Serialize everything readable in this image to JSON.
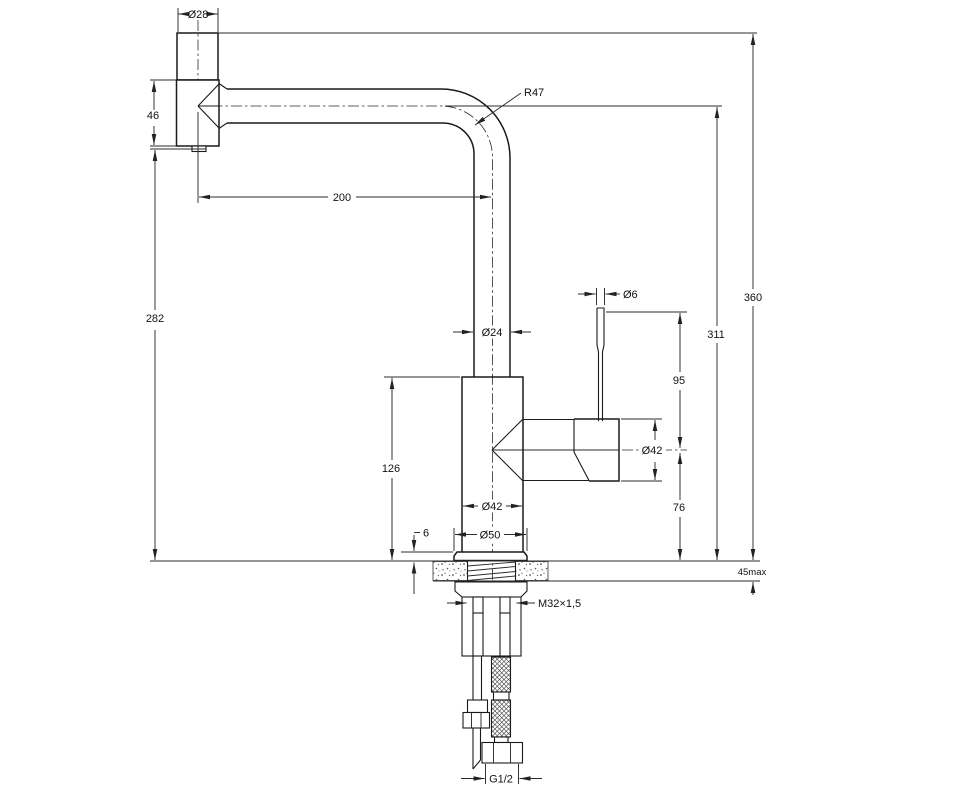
{
  "drawing": {
    "kind": "kitchen-faucet dimensional drawing",
    "colors": {
      "line": "#1a1a1a",
      "background": "#ffffff"
    },
    "labels": {
      "knob_diameter": "Ø28",
      "elbow_height": "46",
      "spout_radius": "R47",
      "spout_reach": "200",
      "outlet_height": "282",
      "lever_diameter": "Ø6",
      "overall_height": "360",
      "spout_axis_height": "311",
      "lever_height": "95",
      "tube_diameter": "Ø24",
      "valve_diameter": "Ø42",
      "body_height": "126",
      "valve_axis_height": "76",
      "body_diameter": "Ø42",
      "flange_thickness": "6",
      "flange_diameter": "Ø50",
      "counter_thickness_max": "45max",
      "shank_thread": "M32×1,5",
      "supply_thread": "G1/2"
    }
  }
}
